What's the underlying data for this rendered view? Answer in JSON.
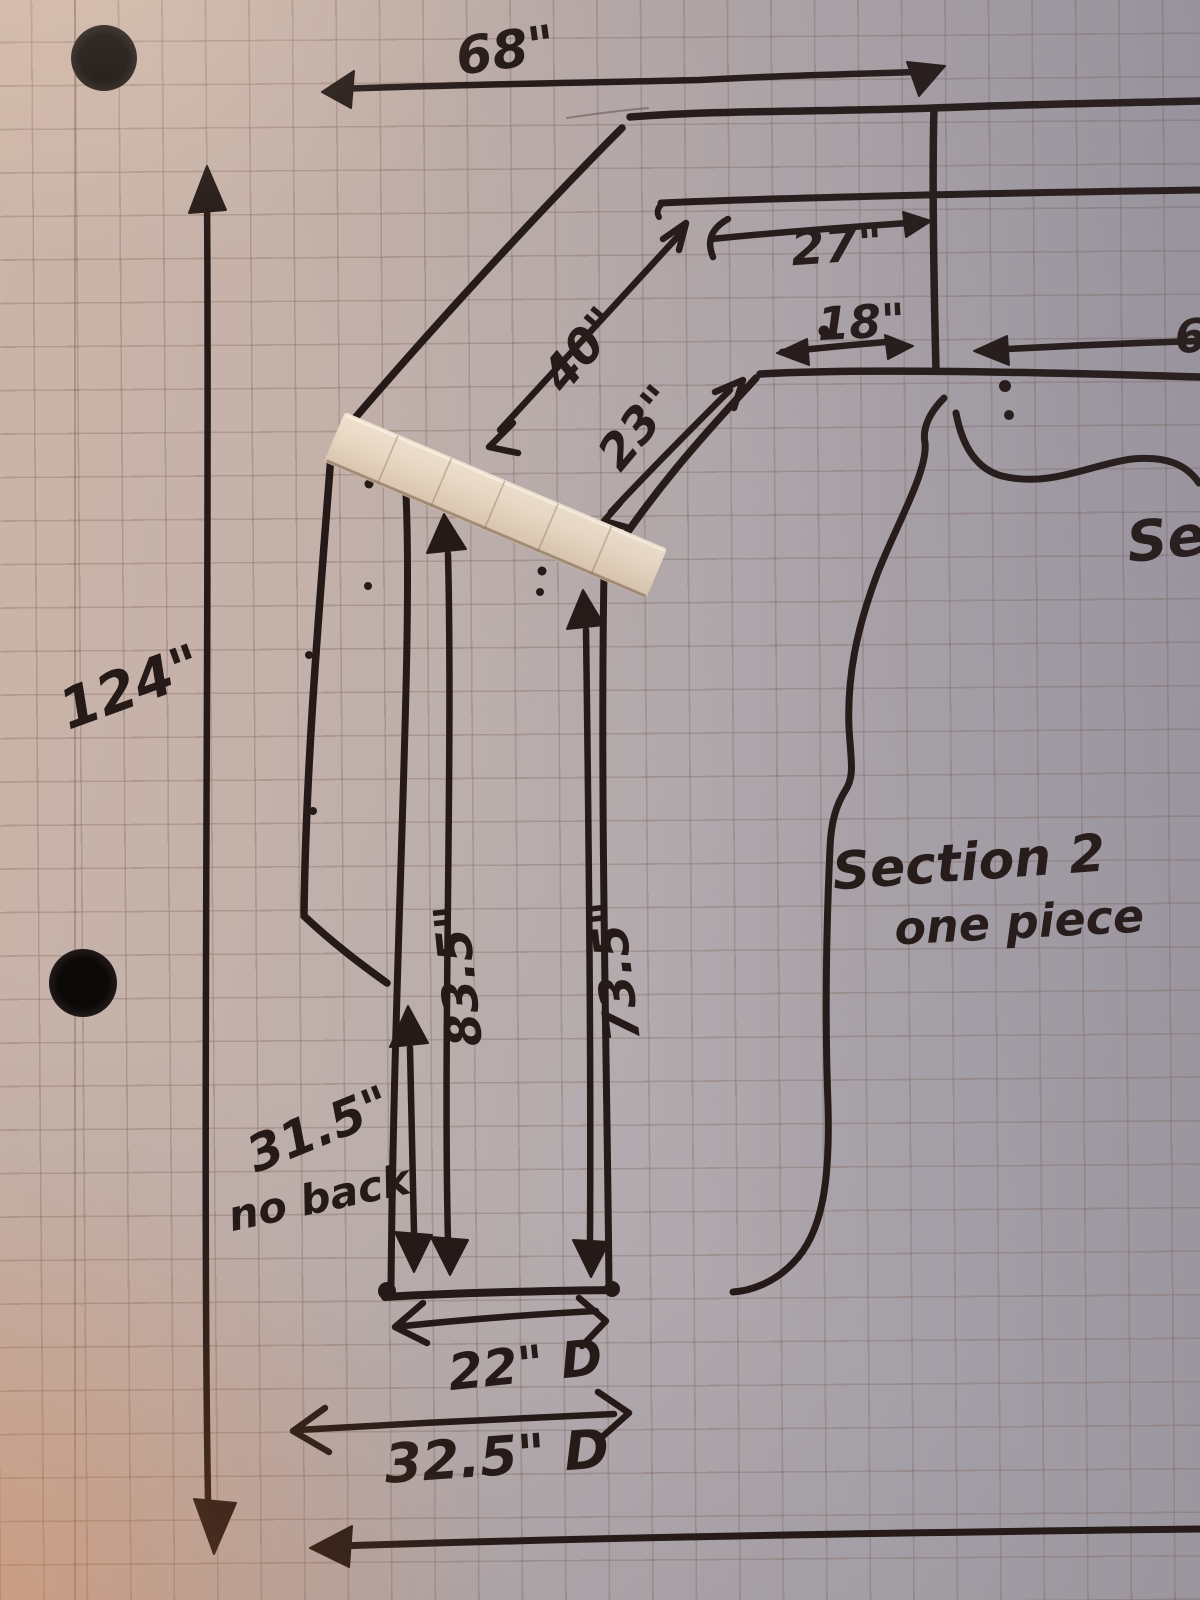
{
  "labels": {
    "height_overall": "124\"",
    "width_top": "68\"",
    "seg_back_right": "27\"",
    "seg_inner_right": "18\"",
    "diag_outer": "40\"",
    "diag_inner": "23\"",
    "no_back_height": "31.5\"",
    "no_back_note": "no back",
    "inner_left_length": "83.5\"",
    "inner_right_length": "73.5\"",
    "depth_inner": "22\" D",
    "depth_outer": "32.5\" D",
    "section_note_line1": "Section 2",
    "section_note_line2": "one piece",
    "right_section_partial": "Se",
    "right_dim_partial": "6"
  },
  "paper": {
    "kind": "quad-ruled graph paper photo",
    "hole_punch_count": 2,
    "tape_segments": 6
  },
  "colors": {
    "ink": "#251a17",
    "paper_warm": "#ccb5a8",
    "paper_cool": "#a09aa2",
    "grid_line": "rgba(122,94,82,0.30)",
    "tape": "#e8d7c2"
  }
}
